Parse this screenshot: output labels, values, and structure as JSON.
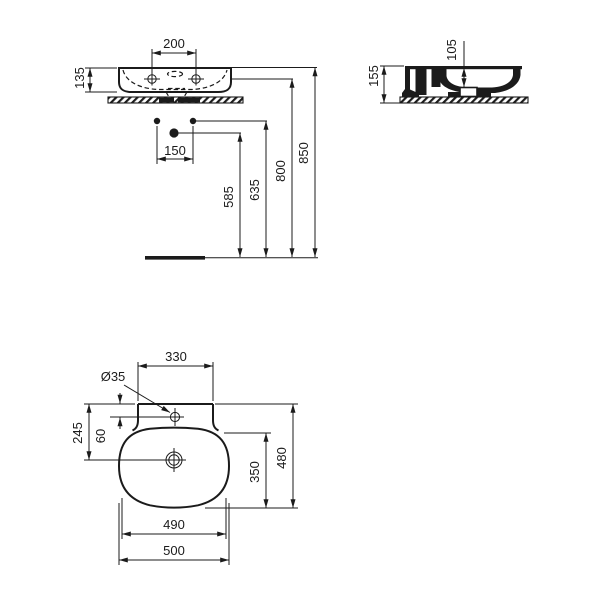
{
  "drawing": {
    "front_view": {
      "tap_hole_spacing": "200",
      "basin_height": "135",
      "fixing_hole_spacing": "150",
      "drain_height": "585",
      "fixing_height": "635",
      "deck_height": "800",
      "rim_height": "850"
    },
    "side_view": {
      "bowl_depth": "105",
      "total_height": "155"
    },
    "plan_view": {
      "back_ledge_width": "330",
      "tap_hole_diameter": "Ø35",
      "back_to_drain": "245",
      "back_to_tap": "60",
      "bowl_length": "350",
      "total_depth": "480",
      "bowl_width": "490",
      "total_width": "500"
    }
  }
}
